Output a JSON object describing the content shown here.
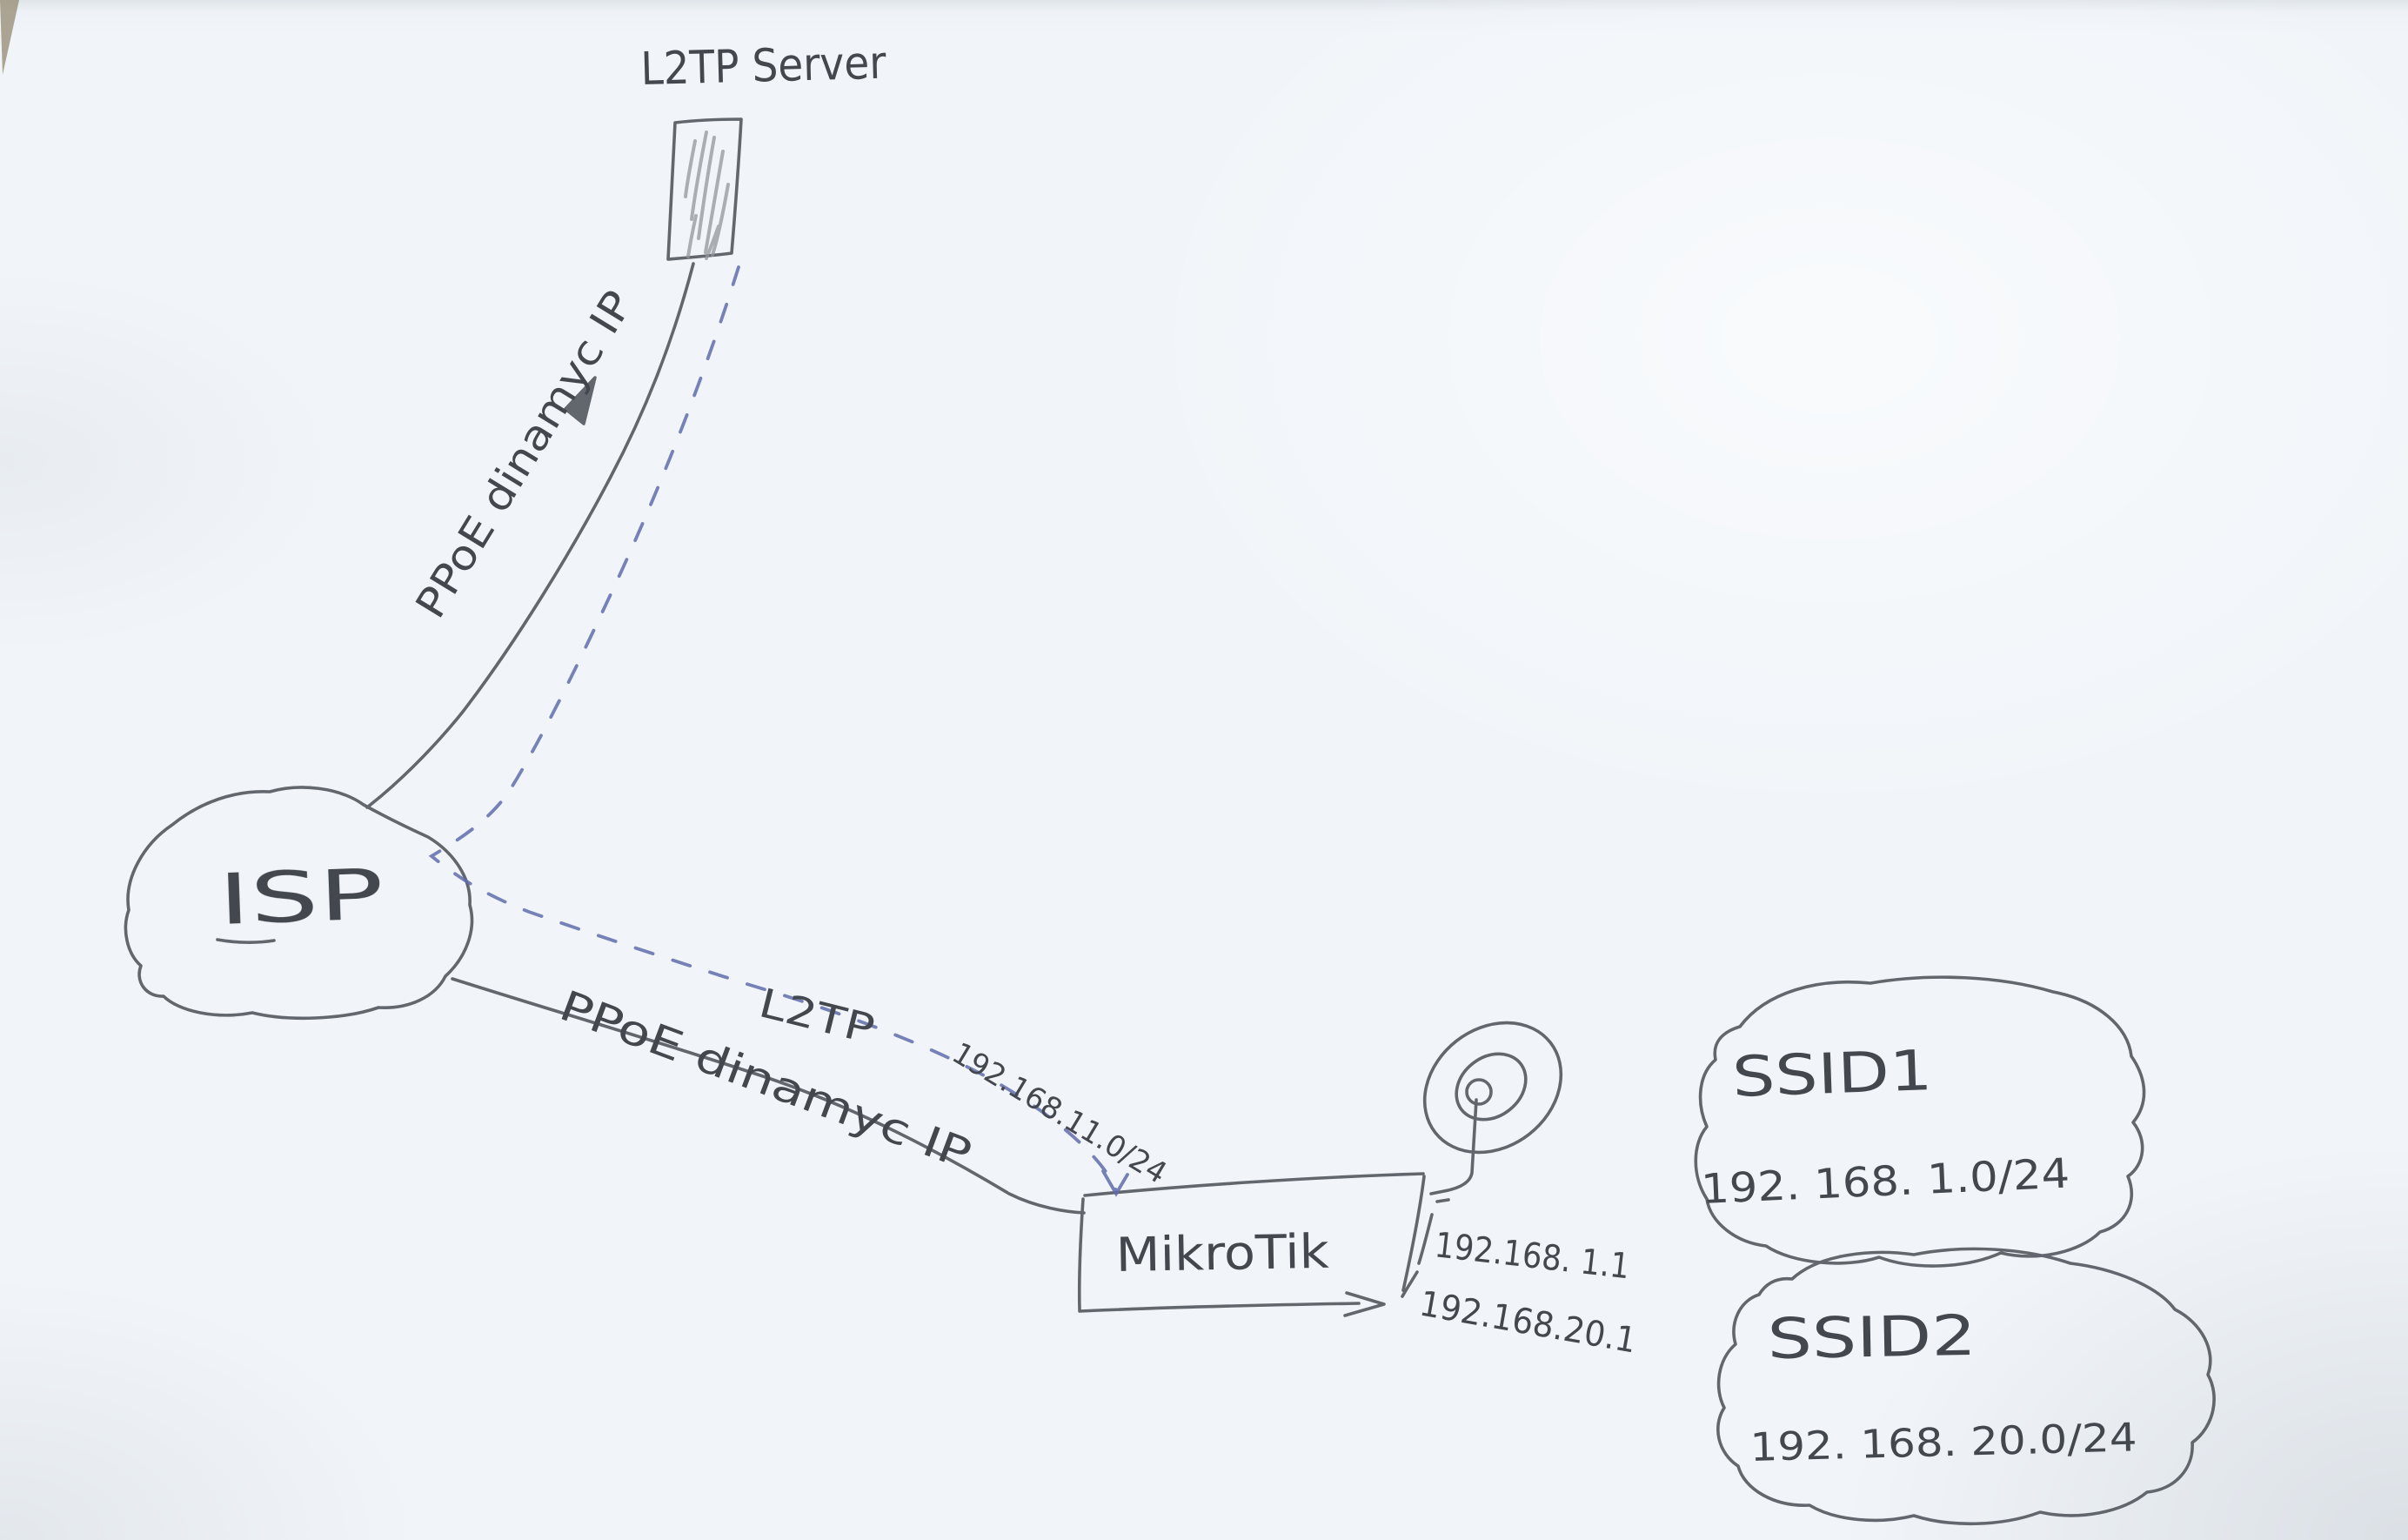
{
  "colors": {
    "paper": "#f1f5f9",
    "pencil_ink": "#565a61",
    "pencil_light": "#8a8d93",
    "pen_blue": "#5f6cab",
    "text_ink": "#43474e",
    "corner_fold": "#9b9079"
  },
  "nodes": {
    "l2tp_server": {
      "label": "L2TP Server"
    },
    "isp": {
      "label": "ISP"
    },
    "mikrotik": {
      "label": "MikroTik",
      "lan_ip_1": "192.168. 1.1",
      "lan_ip_2": "192.168.20.1"
    },
    "ssid1": {
      "name": "SSID1",
      "subnet": "192. 168. 1.0/24"
    },
    "ssid2": {
      "name": "SSID2",
      "subnet": "192. 168. 20.0/24"
    }
  },
  "links": {
    "server_pppoe": {
      "label": "PPoE dinamyc IP"
    },
    "client_pppoe": {
      "label": "PPoE dinamyc IP"
    },
    "l2tp_tunnel": {
      "label": "L2TP",
      "subnet": "192.168.11.0/24"
    }
  }
}
